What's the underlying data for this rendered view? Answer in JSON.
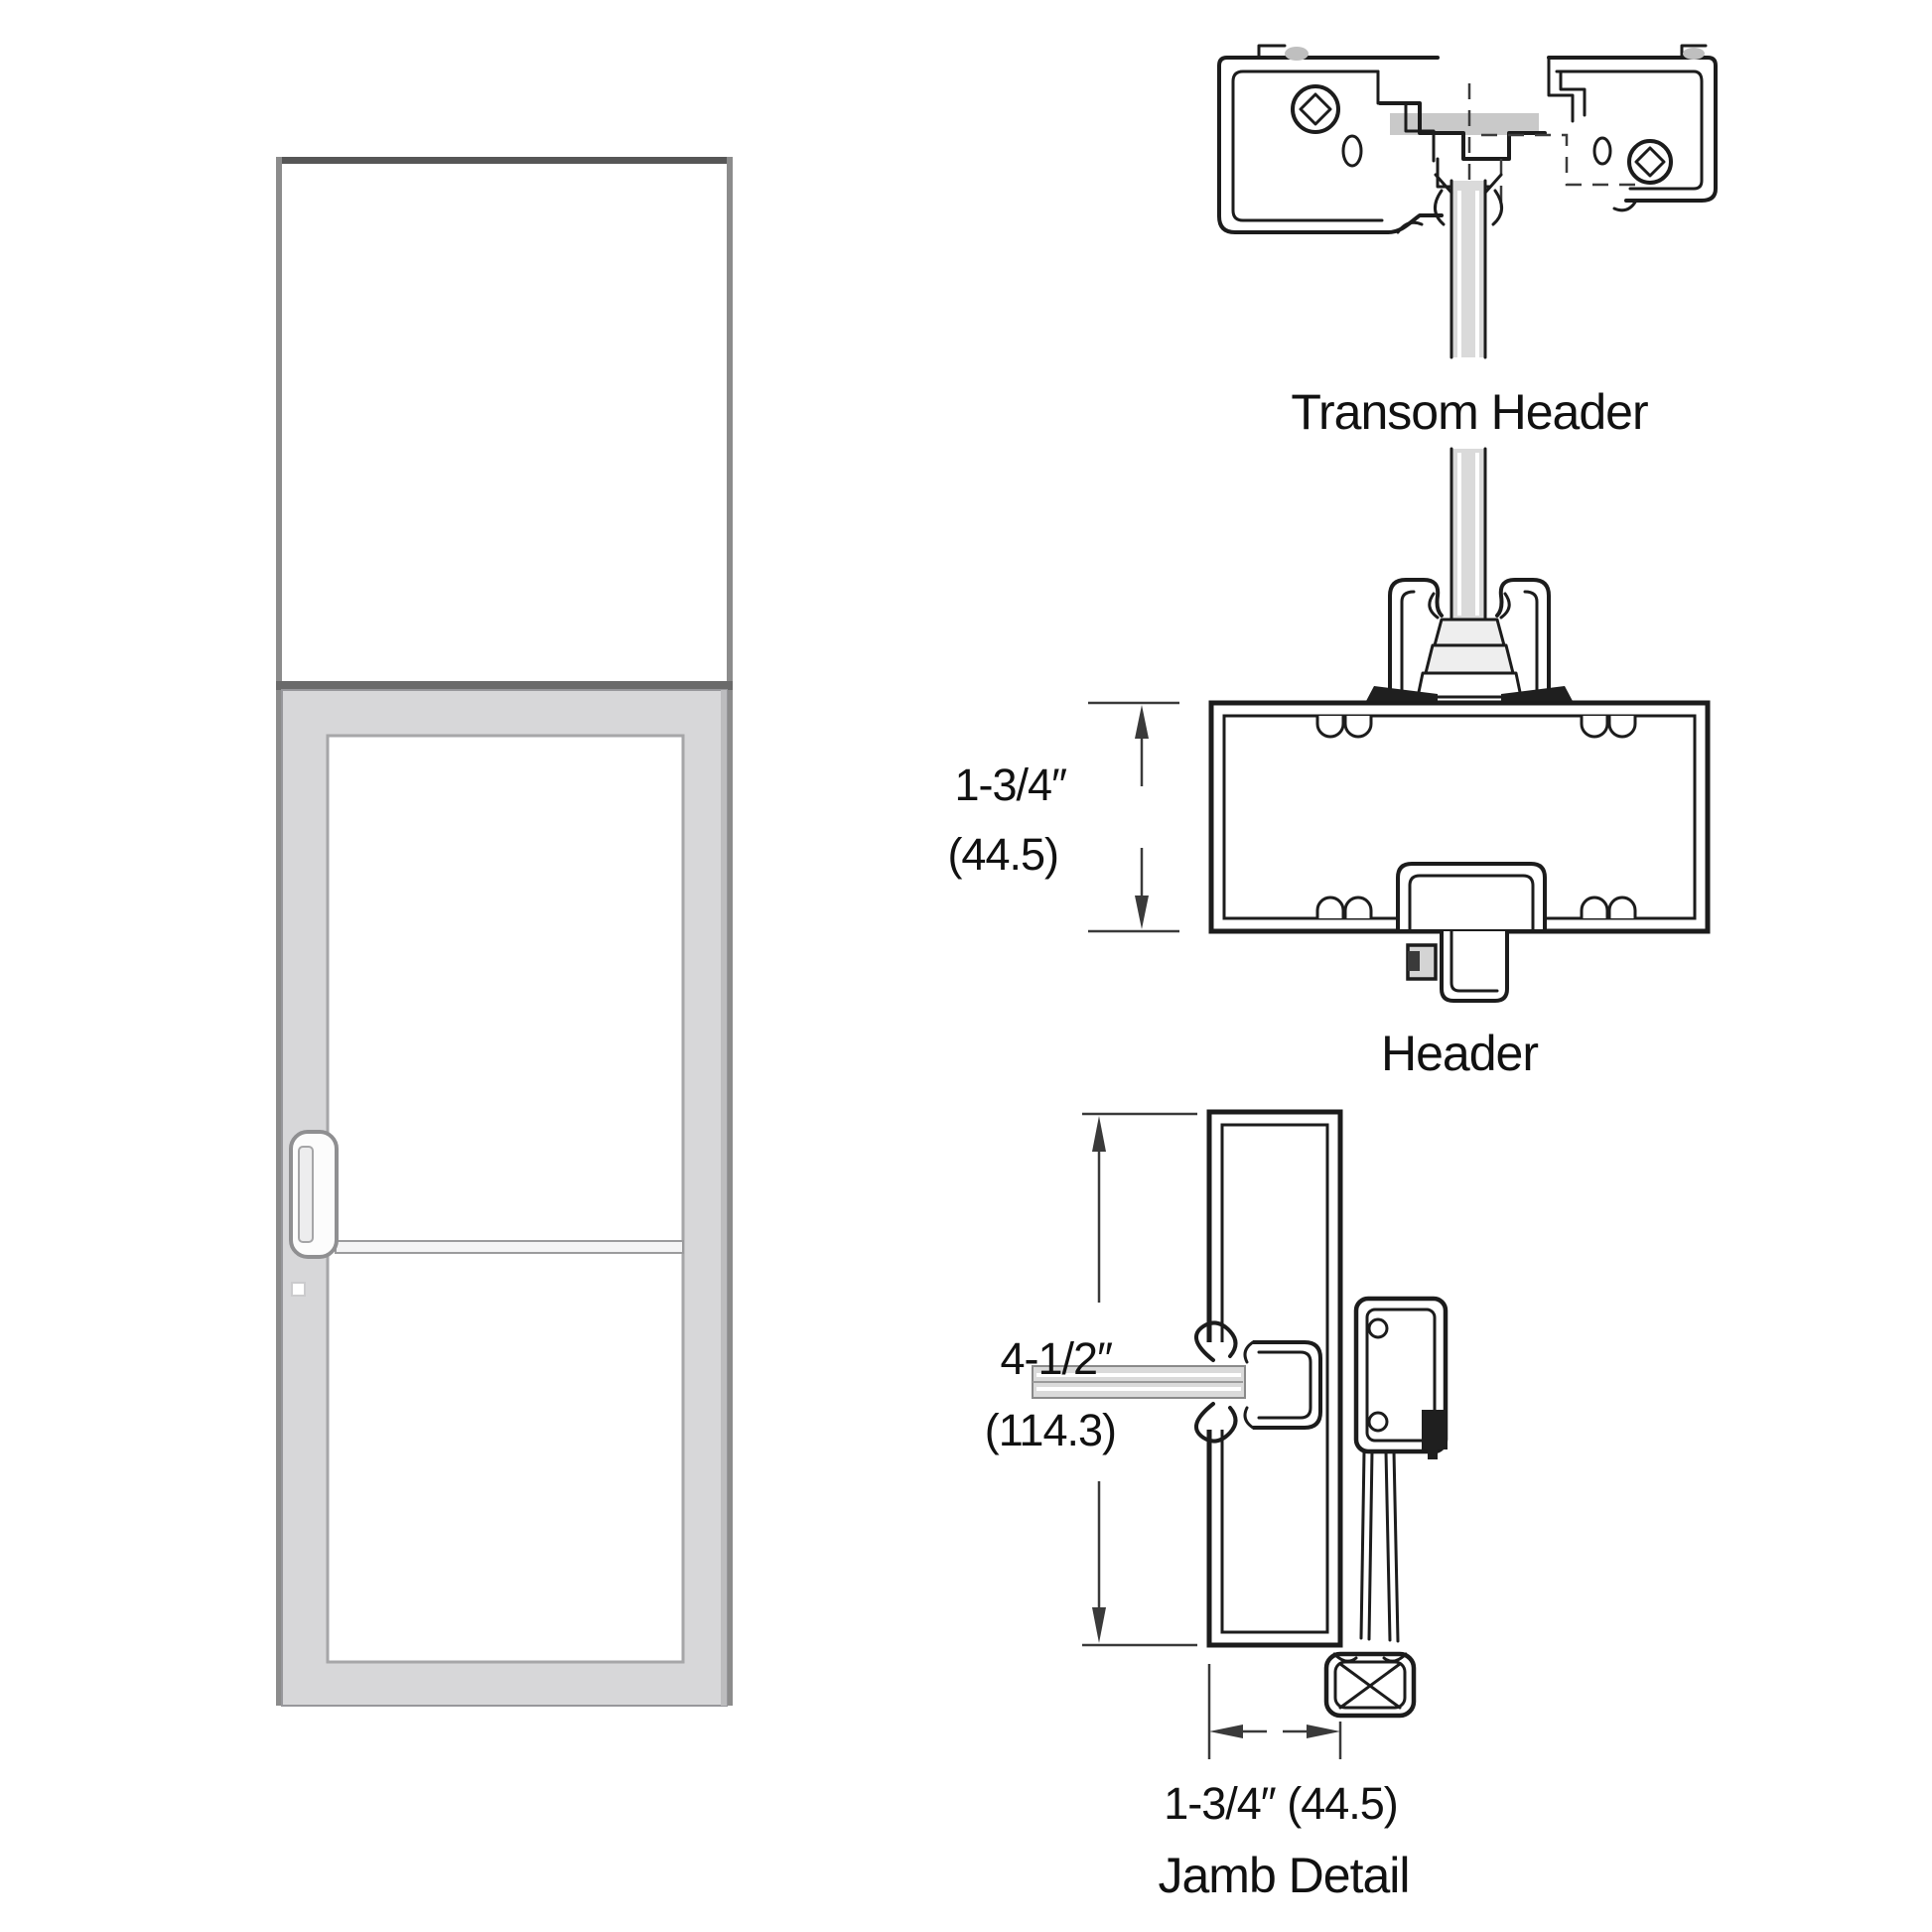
{
  "labels": {
    "transom_header": "Transom Header",
    "header": "Header",
    "jamb_detail": "Jamb Detail"
  },
  "dimensions": {
    "header_height": {
      "imperial": "1-3/4″",
      "metric": "(44.5)"
    },
    "jamb_depth": {
      "imperial": "4-1/2″",
      "metric": "(114.3)"
    },
    "jamb_face": {
      "combined": "1-3/4″ (44.5)"
    }
  },
  "colors": {
    "background": "#ffffff",
    "section_line": "#1c1c1c",
    "dimension_line": "#3a3a3a",
    "door_frame_gray": "#d7d7d9",
    "frame_edge_gray": "#8c8c8c",
    "glass_gray": "#dadada"
  }
}
